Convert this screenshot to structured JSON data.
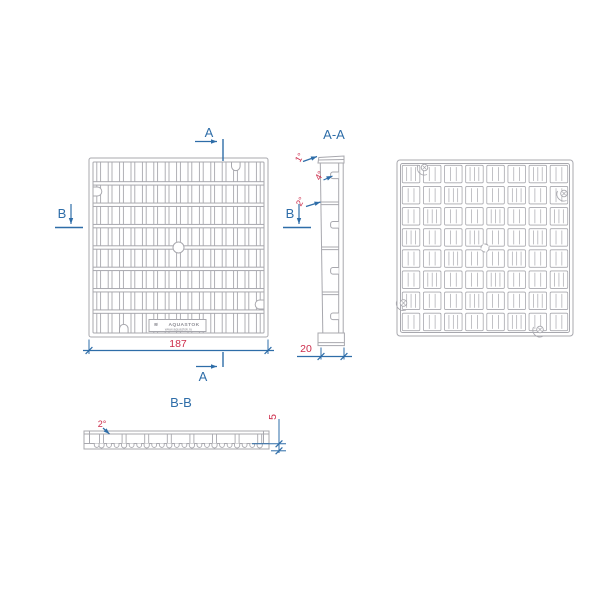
{
  "drawing": {
    "front_view": {
      "dim_width": "187",
      "brand": "AQUASTOK",
      "brand_url": "www.aquastok.ru",
      "brand_logo": "≋"
    },
    "markers": {
      "a": "A",
      "b": "B"
    },
    "section_aa": {
      "title": "A-A",
      "angle_top": "1°",
      "angle_tab": "4°",
      "angle_wall": "2°",
      "dim_depth": "20"
    },
    "section_bb": {
      "title": "B-B",
      "angle_wall": "2°",
      "dim_tooth_height": "5"
    },
    "colors": {
      "geometry": "#a8a8ae",
      "annotation_blue": "#2e6da8",
      "dimension_red": "#cc2b4a",
      "background": "#ffffff"
    }
  }
}
